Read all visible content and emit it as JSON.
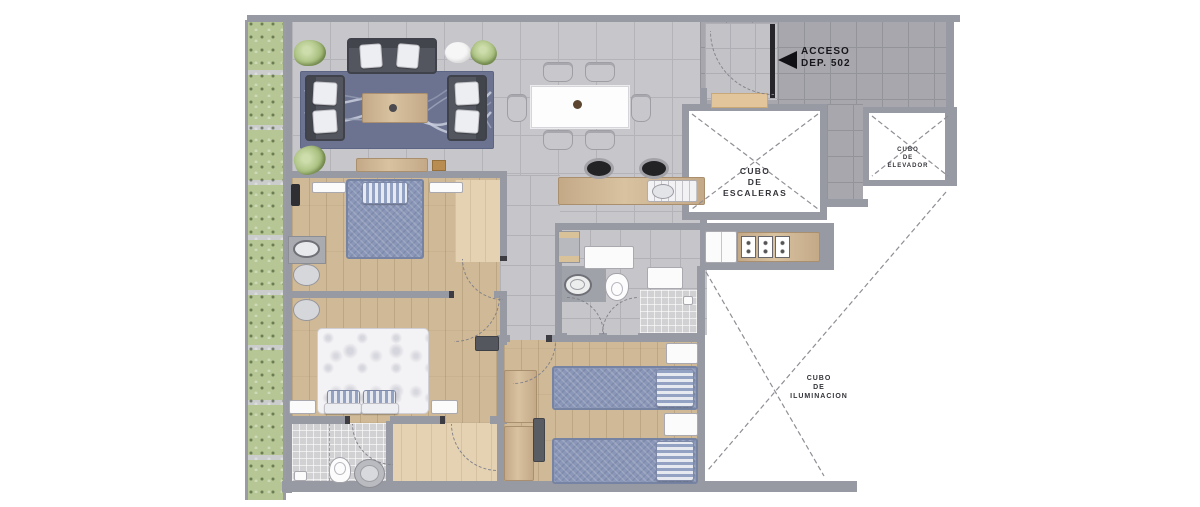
{
  "labels": {
    "access": {
      "line1": "ACCESO",
      "line2": "DEP. 502"
    },
    "stairs": {
      "line1": "CUBO",
      "line2": "DE",
      "line3": "ESCALERAS"
    },
    "elevator": {
      "line1": "CUBO",
      "line2": "DE",
      "line3": "ELEVADOR"
    },
    "light_shaft": {
      "line1": "CUBO",
      "line2": "DE",
      "line3": "ILUMINACION"
    }
  },
  "colors": {
    "wall_gray": "#979aa2",
    "tile_living": "#c7c7cb",
    "tile_corridor": "#a7a7ad",
    "wood_floor": "#cfb996",
    "wood_closet": "#e4d2b3",
    "planter_green": "#b6c694",
    "rug_blue": "#6b7390",
    "bed_blue": "#8b97b8",
    "sofa_gray": "#53565e",
    "fixture_white": "#fbfbfc",
    "arrow_black": "#121216"
  }
}
